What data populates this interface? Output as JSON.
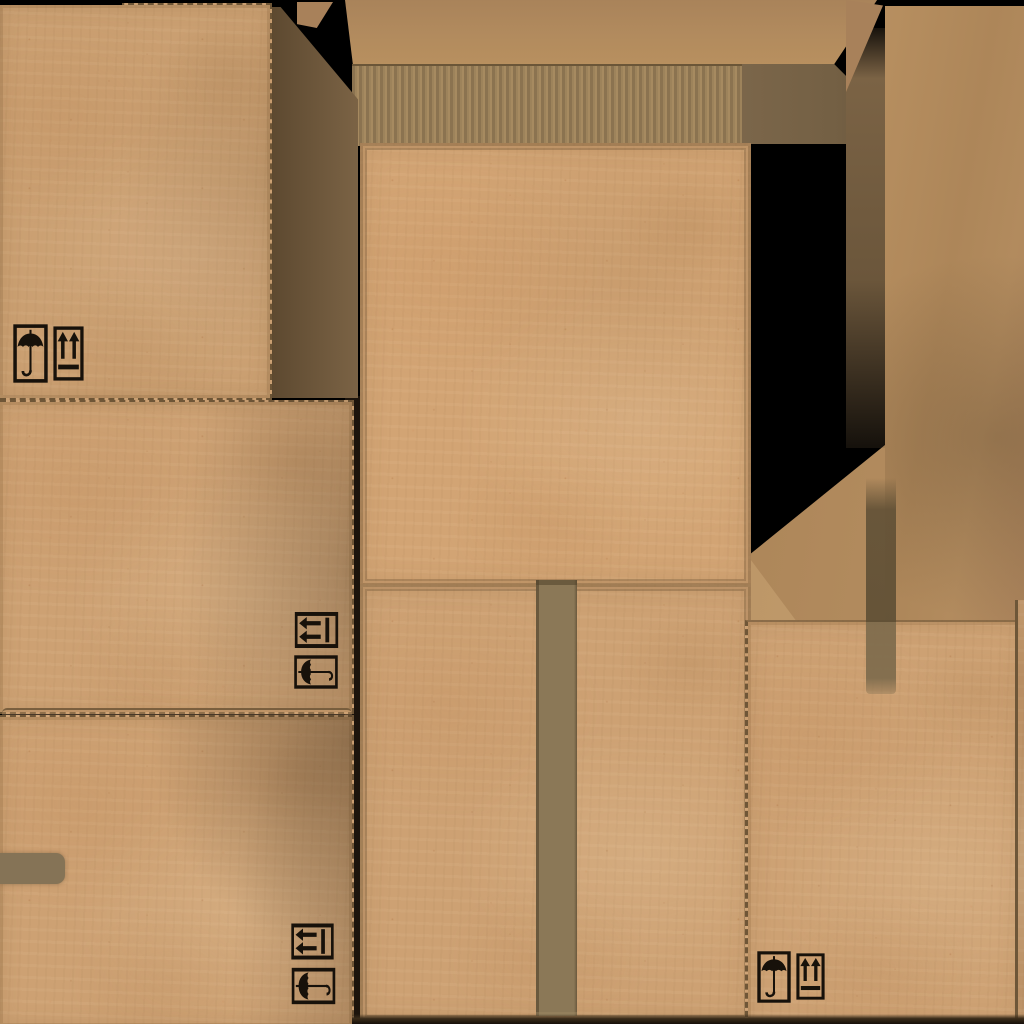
{
  "texture": {
    "name": "cardboard-box-texture-atlas",
    "background_color": "#000000",
    "width_px": 1024,
    "height_px": 1024
  },
  "palette": {
    "bg": "#000000",
    "cardboard": "#cda173",
    "cardboard_dark": "#b98e61",
    "stitch": "#6f5637",
    "groove": "#8d7452",
    "panel_border": "#7d6140",
    "shadow_dark": "#5d4930",
    "shadow_mid": "#7b6345",
    "flap": "#b28b5e",
    "flap_dark": "#a8815a",
    "flute_dark": "#8b7350",
    "flute_light": "#9d835b",
    "flute_edge": "#6b5638",
    "corrugation_shadow": "#746044",
    "tape": "#8b7857",
    "tape_over_flap": "#5f4f35",
    "symbol": "#17110a",
    "gap": "#1c140c",
    "bottom_edge": "#3a2c1a"
  },
  "regions": [
    {
      "id": "panel-top-left",
      "type": "box-face",
      "symbols": [
        "keep-dry",
        "this-side-up"
      ]
    },
    {
      "id": "panel-middle-left",
      "type": "box-face",
      "symbols": [
        "this-side-up-rotated",
        "keep-dry-rotated"
      ]
    },
    {
      "id": "panel-bottom-left",
      "type": "box-face",
      "symbols": [
        "this-side-up-rotated",
        "keep-dry-rotated"
      ],
      "features": [
        "tape-fragment"
      ]
    },
    {
      "id": "panel-center-top",
      "type": "box-face",
      "symbols": []
    },
    {
      "id": "panel-center-bottom",
      "type": "box-face",
      "features": [
        "vertical-tape-strip"
      ]
    },
    {
      "id": "panel-right-bottom",
      "type": "box-face",
      "symbols": [
        "keep-dry",
        "this-side-up"
      ],
      "features": [
        "vertical-tape-strip"
      ]
    },
    {
      "id": "top-flap-strip",
      "type": "box-flap"
    },
    {
      "id": "corrugated-edge",
      "type": "corrugation"
    },
    {
      "id": "right-flap",
      "type": "box-flap"
    },
    {
      "id": "shadow-wedge-left",
      "type": "shadow"
    },
    {
      "id": "shadow-band-right",
      "type": "shadow"
    },
    {
      "id": "bottom-edge-line",
      "type": "edge"
    }
  ],
  "icons": {
    "keep_dry": {
      "name": "keep-dry-umbrella-icon",
      "glyph": "umbrella"
    },
    "this_side_up": {
      "name": "this-side-up-arrows-icon",
      "glyph": "two-arrows-over-bar"
    }
  }
}
